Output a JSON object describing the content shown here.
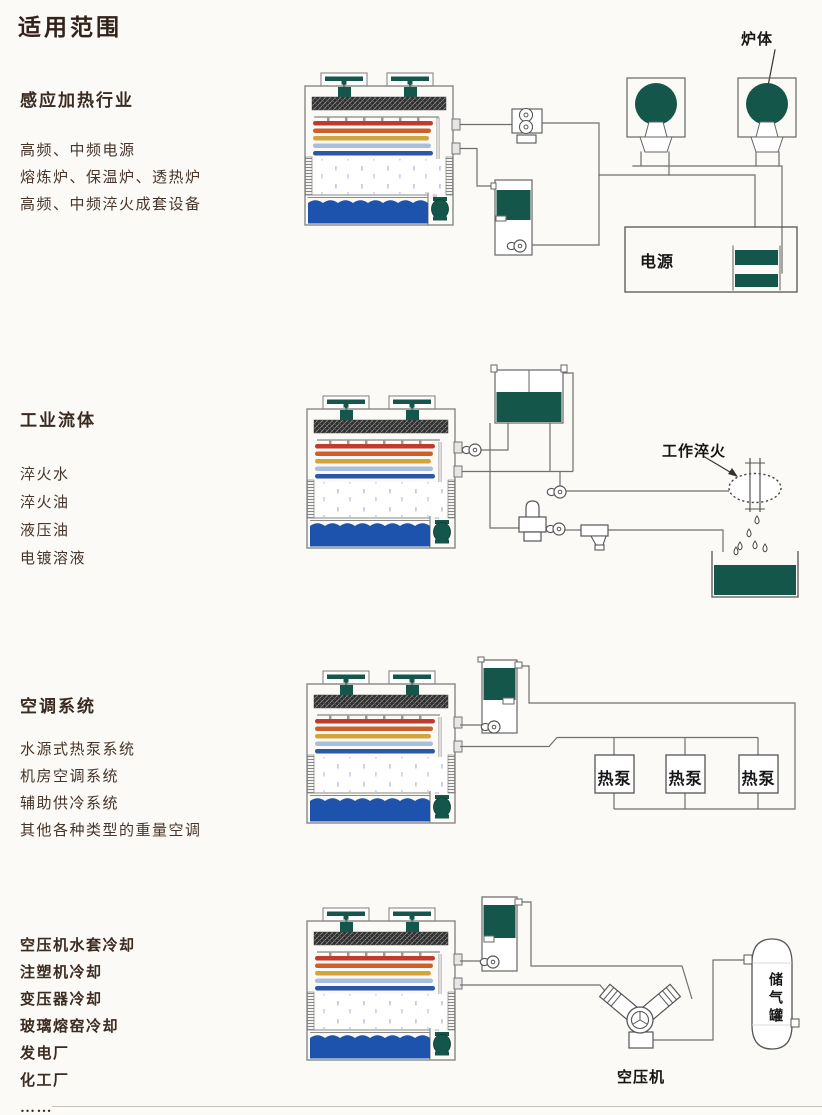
{
  "page": {
    "title": "适用范围"
  },
  "sections": [
    {
      "heading": "感应加热行业",
      "items": [
        "高频、中频电源",
        "熔炼炉、保温炉、透热炉",
        "高频、中频淬火成套设备"
      ],
      "labels": {
        "furnace_body": "炉体",
        "power_supply": "电源"
      }
    },
    {
      "heading": "工业流体",
      "items": [
        "淬火水",
        "淬火油",
        "液压油",
        "电镀溶液"
      ],
      "labels": {
        "work_quench": "工作淬火"
      }
    },
    {
      "heading": "空调系统",
      "items": [
        "水源式热泵系统",
        "机房空调系统",
        "辅助供冷系统",
        "其他各种类型的重量空调"
      ],
      "labels": {
        "heat_pump": "热泵"
      }
    },
    {
      "heading": "",
      "items": [
        "空压机水套冷却",
        "注塑机冷却",
        "变压器冷却",
        "玻璃熔窑冷却",
        "发电厂",
        "化工厂",
        "……"
      ],
      "labels": {
        "air_compressor": "空压机",
        "air_tank": "储气罐"
      }
    }
  ],
  "colors": {
    "dark_green": "#14564a",
    "water_blue": "#1d52ad",
    "coil_red": "#c23a2c",
    "coil_orange": "#cd5f2b",
    "coil_yellow": "#d4a43c",
    "coil_light_blue": "#a8bedd",
    "coil_blue": "#2c56a8",
    "line_gray": "#6f6f6f"
  }
}
